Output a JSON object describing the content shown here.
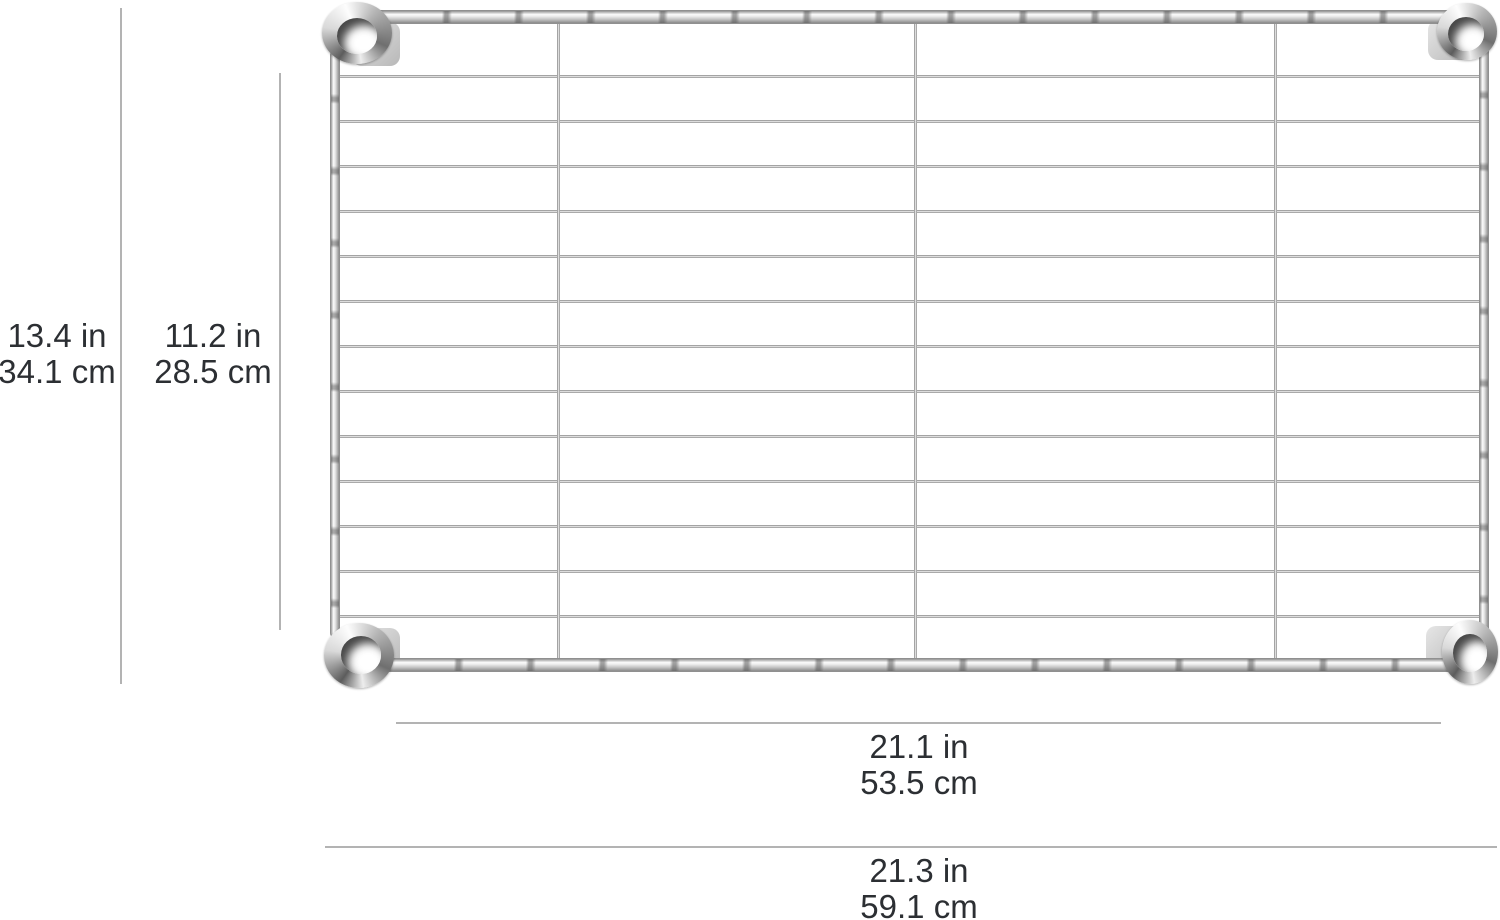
{
  "page": {
    "background": "#ffffff",
    "description": "Product dimension diagram of a chrome wire shelf viewed from above with four corner collars"
  },
  "measurements": {
    "outer_height": {
      "inches": "13.4 in",
      "centimeters": "34.1 cm"
    },
    "inner_height": {
      "inches": "11.2 in",
      "centimeters": "28.5 cm"
    },
    "inner_width": {
      "inches": "21.1 in",
      "centimeters": "53.5 cm"
    },
    "outer_width": {
      "inches": "21.3 in",
      "centimeters": "59.1 cm"
    }
  },
  "shelf": {
    "interior_horizontal_wires": 13,
    "vertical_divider_wires": 3,
    "corner_collars": 4,
    "chrome_highlight": "#fdfdfd",
    "chrome_shadow": "#757575"
  },
  "annotation": {
    "line_color": "#b3b3b3",
    "text_color": "#2c2f33"
  }
}
